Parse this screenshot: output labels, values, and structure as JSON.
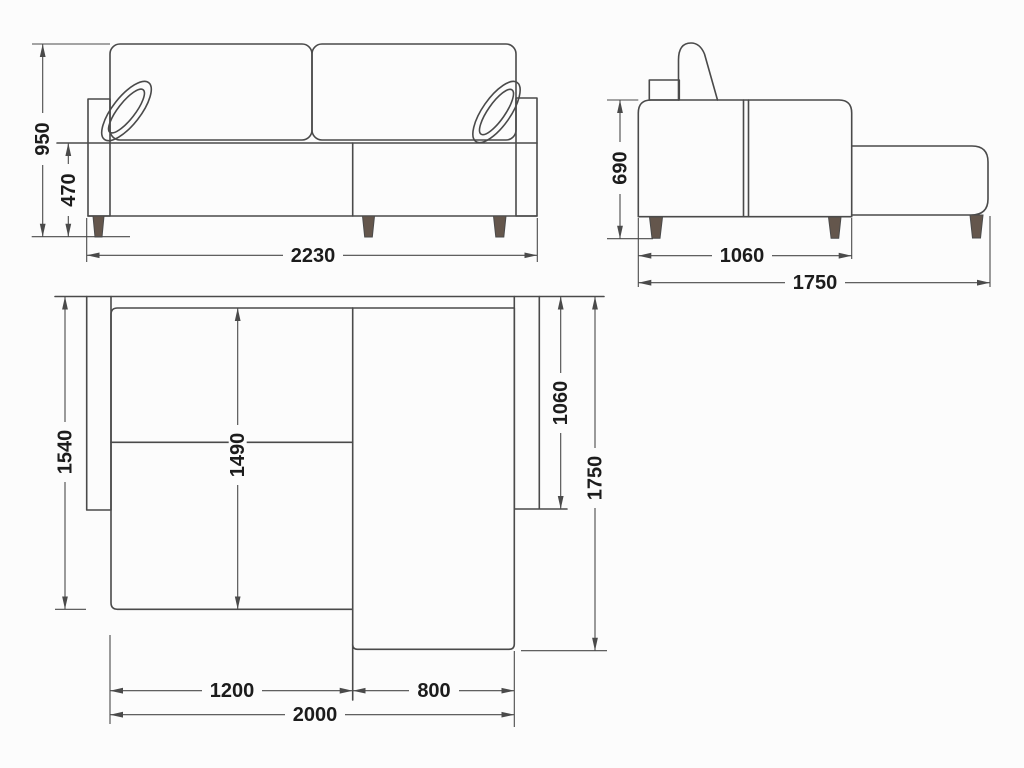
{
  "colors": {
    "background": "#fcfcfc",
    "line": "#4a4a4a",
    "text": "#1c1c1c",
    "leg_fill": "#64564c"
  },
  "views": {
    "front": {
      "dims": {
        "total_height": "950",
        "seat_height": "470",
        "total_width": "2230"
      }
    },
    "side": {
      "dims": {
        "back_height": "690",
        "body_depth": "1060",
        "total_depth": "1750"
      }
    },
    "top": {
      "dims": {
        "left_side_depth": "1540",
        "seat_depth": "1490",
        "right_body_depth": "1060",
        "total_depth": "1750",
        "seat_section_width": "1200",
        "chaise_section_width": "800",
        "frame_width": "2000"
      }
    }
  }
}
